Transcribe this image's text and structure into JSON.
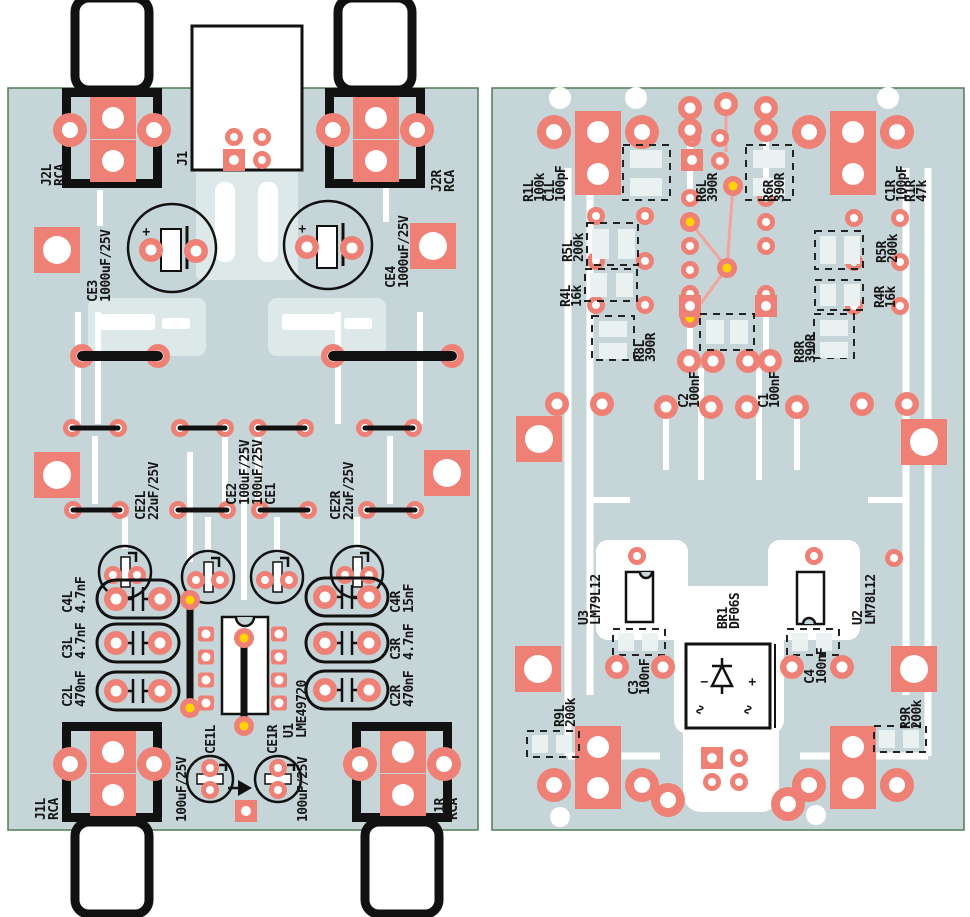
{
  "colors": {
    "board": "#c6d6d8",
    "pad": "#ee8076",
    "copper_trace": "#ffffff",
    "silkscreen": "#111111",
    "board_edge": "#4f7d55",
    "via_tented": "#ffd400",
    "thin_trace_pink": "#f2a39b"
  },
  "left_board": {
    "labels": {
      "j2l": {
        "ref": "J2L",
        "value": "RCA"
      },
      "j2r": {
        "ref": "J2R",
        "value": "RCA"
      },
      "j1": {
        "ref": "J1"
      },
      "ce3": {
        "ref": "CE3",
        "value": "1000uF/25V"
      },
      "ce4": {
        "ref": "CE4",
        "value": "1000uF/25V"
      },
      "ce2l": {
        "ref": "CE2L",
        "value": "22uF/25V"
      },
      "ce2": {
        "ref": "CE2",
        "value": "100uF/25V"
      },
      "ce1": {
        "ref": "CE1",
        "value": "100uF/25V"
      },
      "ce2r": {
        "ref": "CE2R",
        "value": "22uF/25V"
      },
      "c4l": {
        "ref": "C4L",
        "value": "4.7nF"
      },
      "c3l": {
        "ref": "C3L",
        "value": "4.7nF"
      },
      "c2l": {
        "ref": "C2L",
        "value": "470nF"
      },
      "c4r": {
        "ref": "C4R",
        "value": "15nF"
      },
      "c3r": {
        "ref": "C3R",
        "value": "4.7nF"
      },
      "c2r": {
        "ref": "C2R",
        "value": "470nF"
      },
      "u1": {
        "ref": "U1",
        "value": "LME49720"
      },
      "ce1l": {
        "ref": "CE1L",
        "value": "100uF/25V"
      },
      "ce1r": {
        "ref": "CE1R",
        "value": "100uF/25V"
      },
      "j1l": {
        "ref": "J1L",
        "value": "RCA"
      },
      "j1r": {
        "ref": "J1R",
        "value": "RCA"
      },
      "plus": "+"
    }
  },
  "right_board": {
    "labels": {
      "r1l": {
        "ref": "R1L",
        "value": "100k"
      },
      "c1l": {
        "ref": "C1L",
        "value": "100pF"
      },
      "r5l": {
        "ref": "R5L",
        "value": "200k"
      },
      "r4l": {
        "ref": "R4L",
        "value": "16k"
      },
      "r6l": {
        "ref": "R6L",
        "value": "390R"
      },
      "r6r": {
        "ref": "R6R",
        "value": "390R"
      },
      "c1r": {
        "ref": "C1R",
        "value": "100pF"
      },
      "r1r": {
        "ref": "R1R",
        "value": "47k"
      },
      "r5r": {
        "ref": "R5R",
        "value": "200k"
      },
      "r4r": {
        "ref": "R4R",
        "value": "16k"
      },
      "r8l": {
        "ref": "R8L",
        "value": "390R"
      },
      "r8r": {
        "ref": "R8R",
        "value": "390R"
      },
      "c2": {
        "ref": "C2",
        "value": "100nF"
      },
      "c1": {
        "ref": "C1",
        "value": "100nF"
      },
      "u3": {
        "ref": "U3",
        "value": "LM79L12"
      },
      "u2": {
        "ref": "U2",
        "value": "LM78L12"
      },
      "c3": {
        "ref": "C3",
        "value": "100nF"
      },
      "c4": {
        "ref": "C4",
        "value": "100nF"
      },
      "br1": {
        "ref": "BR1",
        "value": "DF06S"
      },
      "r9l": {
        "ref": "R9L",
        "value": "200k"
      },
      "r9r": {
        "ref": "R9R",
        "value": "200k"
      },
      "bridge_minus": "−",
      "bridge_plus": "+",
      "bridge_ac": "∿"
    }
  }
}
